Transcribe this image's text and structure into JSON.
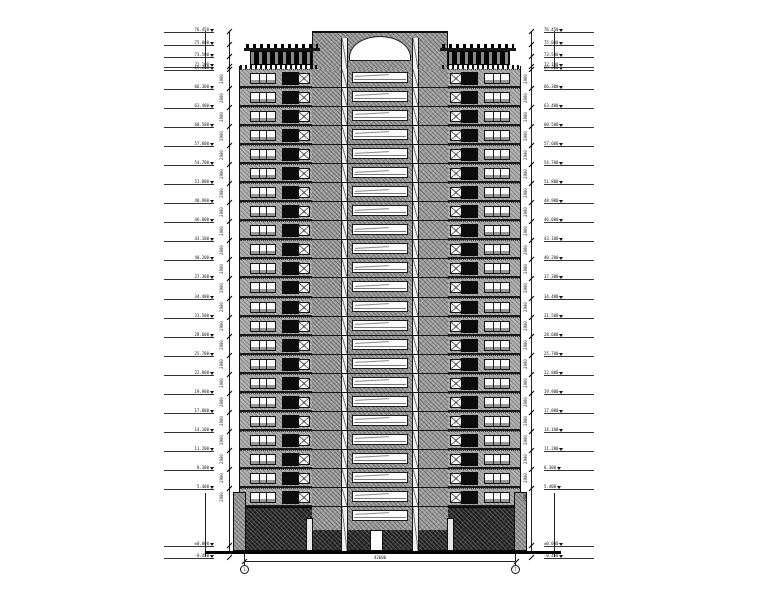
{
  "drawing": {
    "kind": "building-elevation",
    "typical_floor_count": 23
  },
  "colors": {
    "background": "#ffffff",
    "core_hatch": "#9e9e9e",
    "wing_wall": "#b2b2b2",
    "podium_stone": "#1d1d1d",
    "dark_panel": "#0b0b0b",
    "line": "#111111"
  },
  "levels": {
    "crown": [
      "76.450",
      "75.000",
      "73.500",
      "72.100"
    ],
    "floors": [
      "69.200",
      "66.300",
      "63.400",
      "60.500",
      "57.600",
      "54.700",
      "51.800",
      "48.900",
      "46.000",
      "43.100",
      "40.200",
      "37.300",
      "34.400",
      "31.500",
      "28.600",
      "25.700",
      "22.800",
      "19.900",
      "17.000",
      "14.100",
      "11.200",
      "8.300",
      "5.400"
    ],
    "base": [
      "±0.000",
      "-0.450"
    ]
  },
  "dimensions": {
    "floor_height": "2900",
    "total_width": "42600",
    "ground_level": "-0.450"
  },
  "grid": {
    "left_bubble": "1",
    "right_bubble": "7"
  }
}
